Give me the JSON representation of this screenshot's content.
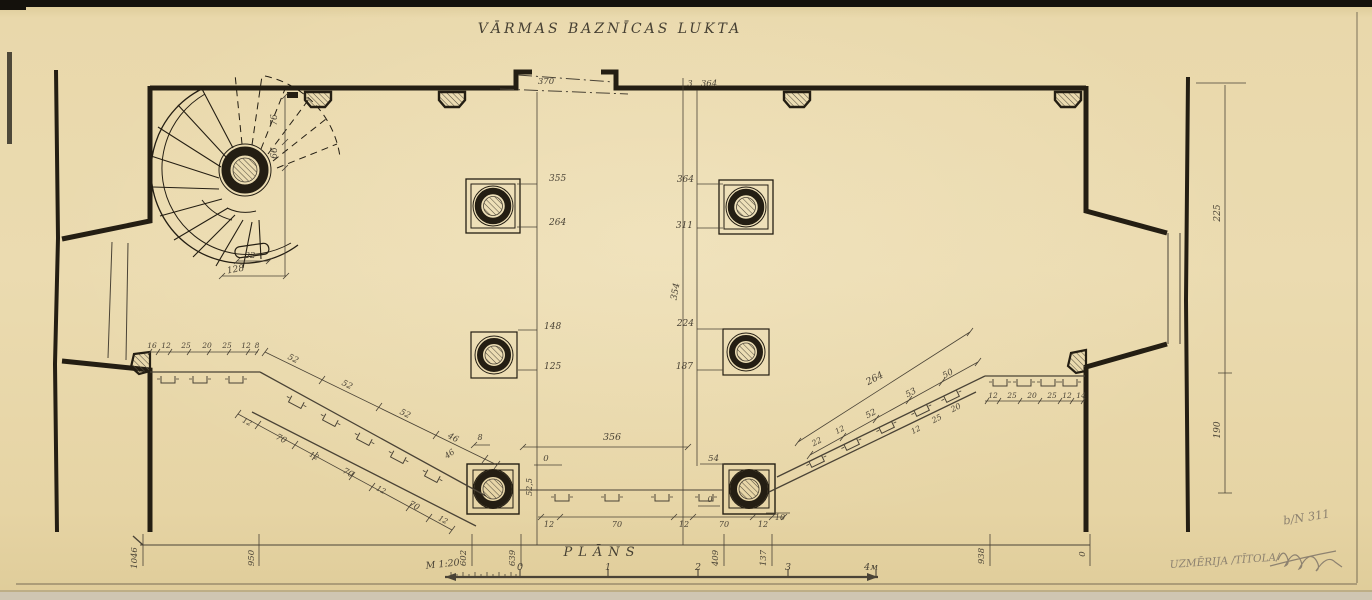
{
  "sheet": {
    "title": "VĀRMAS  BAZNĪCAS  LUKTA",
    "plan_caption": "PLĀNS",
    "scale_note": "M 1:20",
    "drawing_number": "b/N 311",
    "surveyor_note": "UZMĒRIJA /TĪTOLA/"
  },
  "scale_bar": {
    "tick_labels": [
      "0",
      "1",
      "2",
      "3",
      "4м"
    ]
  },
  "colors": {
    "paper": "#e8d7a9",
    "ink": "#241e13",
    "dim": "#4a4336",
    "pencil": "#8d8270"
  },
  "dimension_labels": [
    {
      "t": "76",
      "x": 277,
      "y": 120,
      "r": -90,
      "s": 9
    },
    {
      "t": "66",
      "x": 277,
      "y": 153,
      "r": -90,
      "s": 9
    },
    {
      "t": "32",
      "x": 250,
      "y": 258,
      "s": 8.5
    },
    {
      "t": "128",
      "x": 236,
      "y": 272,
      "r": -10,
      "s": 9
    },
    {
      "t": "370",
      "x": 546,
      "y": 84,
      "s": 8.5
    },
    {
      "t": "3",
      "x": 690,
      "y": 86,
      "s": 8
    },
    {
      "t": "364",
      "x": 709,
      "y": 86,
      "s": 8.5
    },
    {
      "t": "355",
      "x": 549,
      "y": 181,
      "s": 9,
      "a": "start"
    },
    {
      "t": "264",
      "x": 549,
      "y": 225,
      "s": 9,
      "a": "start"
    },
    {
      "t": "364",
      "x": 694,
      "y": 182,
      "s": 9,
      "a": "end"
    },
    {
      "t": "311",
      "x": 693,
      "y": 228,
      "s": 9,
      "a": "end"
    },
    {
      "t": "354",
      "x": 678,
      "y": 292,
      "r": -80,
      "s": 9
    },
    {
      "t": "148",
      "x": 544,
      "y": 329,
      "s": 9,
      "a": "start"
    },
    {
      "t": "125",
      "x": 544,
      "y": 369,
      "s": 9,
      "a": "start"
    },
    {
      "t": "224",
      "x": 694,
      "y": 326,
      "s": 9,
      "a": "end"
    },
    {
      "t": "187",
      "x": 693,
      "y": 369,
      "s": 9,
      "a": "end"
    },
    {
      "t": "356",
      "x": 612,
      "y": 440,
      "s": 9.5
    },
    {
      "t": "0",
      "x": 546,
      "y": 461,
      "s": 8.5
    },
    {
      "t": "52,5",
      "x": 532,
      "y": 487,
      "r": -90,
      "s": 8
    },
    {
      "t": "54",
      "x": 719,
      "y": 461,
      "s": 8.5,
      "a": "end"
    },
    {
      "t": "0",
      "x": 710,
      "y": 502,
      "s": 8
    },
    {
      "t": "12",
      "x": 549,
      "y": 527,
      "s": 8
    },
    {
      "t": "70",
      "x": 617,
      "y": 527,
      "s": 8
    },
    {
      "t": "12",
      "x": 684,
      "y": 527,
      "s": 8
    },
    {
      "t": "70",
      "x": 724,
      "y": 527,
      "s": 8
    },
    {
      "t": "12",
      "x": 763,
      "y": 527,
      "s": 8
    },
    {
      "t": "10",
      "x": 780,
      "y": 520,
      "s": 8
    },
    {
      "t": "8",
      "x": 480,
      "y": 440,
      "s": 8
    },
    {
      "t": "46",
      "x": 451,
      "y": 456,
      "r": -35,
      "s": 8
    },
    {
      "t": "16",
      "x": 152,
      "y": 348,
      "s": 7.5
    },
    {
      "t": "12",
      "x": 166,
      "y": 348,
      "s": 7.5
    },
    {
      "t": "25",
      "x": 186,
      "y": 348,
      "s": 7.5
    },
    {
      "t": "20",
      "x": 207,
      "y": 348,
      "s": 7.5
    },
    {
      "t": "25",
      "x": 227,
      "y": 348,
      "s": 7.5
    },
    {
      "t": "12",
      "x": 246,
      "y": 348,
      "s": 7.5
    },
    {
      "t": "8",
      "x": 257,
      "y": 348,
      "s": 7.5
    },
    {
      "t": "52",
      "x": 292,
      "y": 361,
      "r": 27,
      "s": 8.5
    },
    {
      "t": "52",
      "x": 346,
      "y": 387,
      "r": 27,
      "s": 8.5
    },
    {
      "t": "52",
      "x": 404,
      "y": 416,
      "r": 27,
      "s": 8.5
    },
    {
      "t": "46",
      "x": 452,
      "y": 440,
      "r": 27,
      "s": 8.5
    },
    {
      "t": "12",
      "x": 246,
      "y": 424,
      "r": 28,
      "s": 7.5
    },
    {
      "t": "70",
      "x": 280,
      "y": 441,
      "r": 28,
      "s": 8.5
    },
    {
      "t": "12",
      "x": 313,
      "y": 458,
      "r": 28,
      "s": 7.5
    },
    {
      "t": "70",
      "x": 347,
      "y": 475,
      "r": 28,
      "s": 8.5
    },
    {
      "t": "12",
      "x": 380,
      "y": 492,
      "r": 28,
      "s": 7.5
    },
    {
      "t": "70",
      "x": 413,
      "y": 508,
      "r": 28,
      "s": 8.5
    },
    {
      "t": "12",
      "x": 442,
      "y": 522,
      "r": 28,
      "s": 7.5
    },
    {
      "t": "12",
      "x": 993,
      "y": 398,
      "s": 7.5
    },
    {
      "t": "25",
      "x": 1012,
      "y": 398,
      "s": 7.5
    },
    {
      "t": "20",
      "x": 1032,
      "y": 398,
      "s": 7.5
    },
    {
      "t": "25",
      "x": 1052,
      "y": 398,
      "s": 7.5
    },
    {
      "t": "12",
      "x": 1067,
      "y": 398,
      "s": 7.5
    },
    {
      "t": "14",
      "x": 1081,
      "y": 398,
      "s": 7.5
    },
    {
      "t": "264",
      "x": 876,
      "y": 381,
      "r": -28,
      "s": 9.5
    },
    {
      "t": "22",
      "x": 818,
      "y": 444,
      "r": -28,
      "s": 8
    },
    {
      "t": "12",
      "x": 841,
      "y": 432,
      "r": -28,
      "s": 7.5
    },
    {
      "t": "52",
      "x": 872,
      "y": 416,
      "r": -28,
      "s": 8.5
    },
    {
      "t": "53",
      "x": 912,
      "y": 395,
      "r": -28,
      "s": 8.5
    },
    {
      "t": "50",
      "x": 949,
      "y": 376,
      "r": -28,
      "s": 8.5
    },
    {
      "t": "12",
      "x": 917,
      "y": 432,
      "r": -28,
      "s": 7.5
    },
    {
      "t": "25",
      "x": 938,
      "y": 421,
      "r": -28,
      "s": 8
    },
    {
      "t": "20",
      "x": 957,
      "y": 410,
      "r": -28,
      "s": 8
    },
    {
      "t": "225",
      "x": 1220,
      "y": 213,
      "r": -90,
      "s": 9
    },
    {
      "t": "190",
      "x": 1220,
      "y": 430,
      "r": -90,
      "s": 9
    },
    {
      "t": "1046",
      "x": 137,
      "y": 558,
      "r": -90,
      "s": 8.5
    },
    {
      "t": "950",
      "x": 254,
      "y": 558,
      "r": -90,
      "s": 8.5
    },
    {
      "t": "602",
      "x": 466,
      "y": 558,
      "r": -90,
      "s": 8.5
    },
    {
      "t": "639",
      "x": 515,
      "y": 558,
      "r": -90,
      "s": 8.5
    },
    {
      "t": "409",
      "x": 718,
      "y": 558,
      "r": -90,
      "s": 8.5
    },
    {
      "t": "137",
      "x": 766,
      "y": 558,
      "r": -90,
      "s": 8.5
    },
    {
      "t": "938",
      "x": 984,
      "y": 556,
      "r": -90,
      "s": 8.5
    },
    {
      "t": "0",
      "x": 1085,
      "y": 554,
      "r": -90,
      "s": 8.5
    }
  ]
}
